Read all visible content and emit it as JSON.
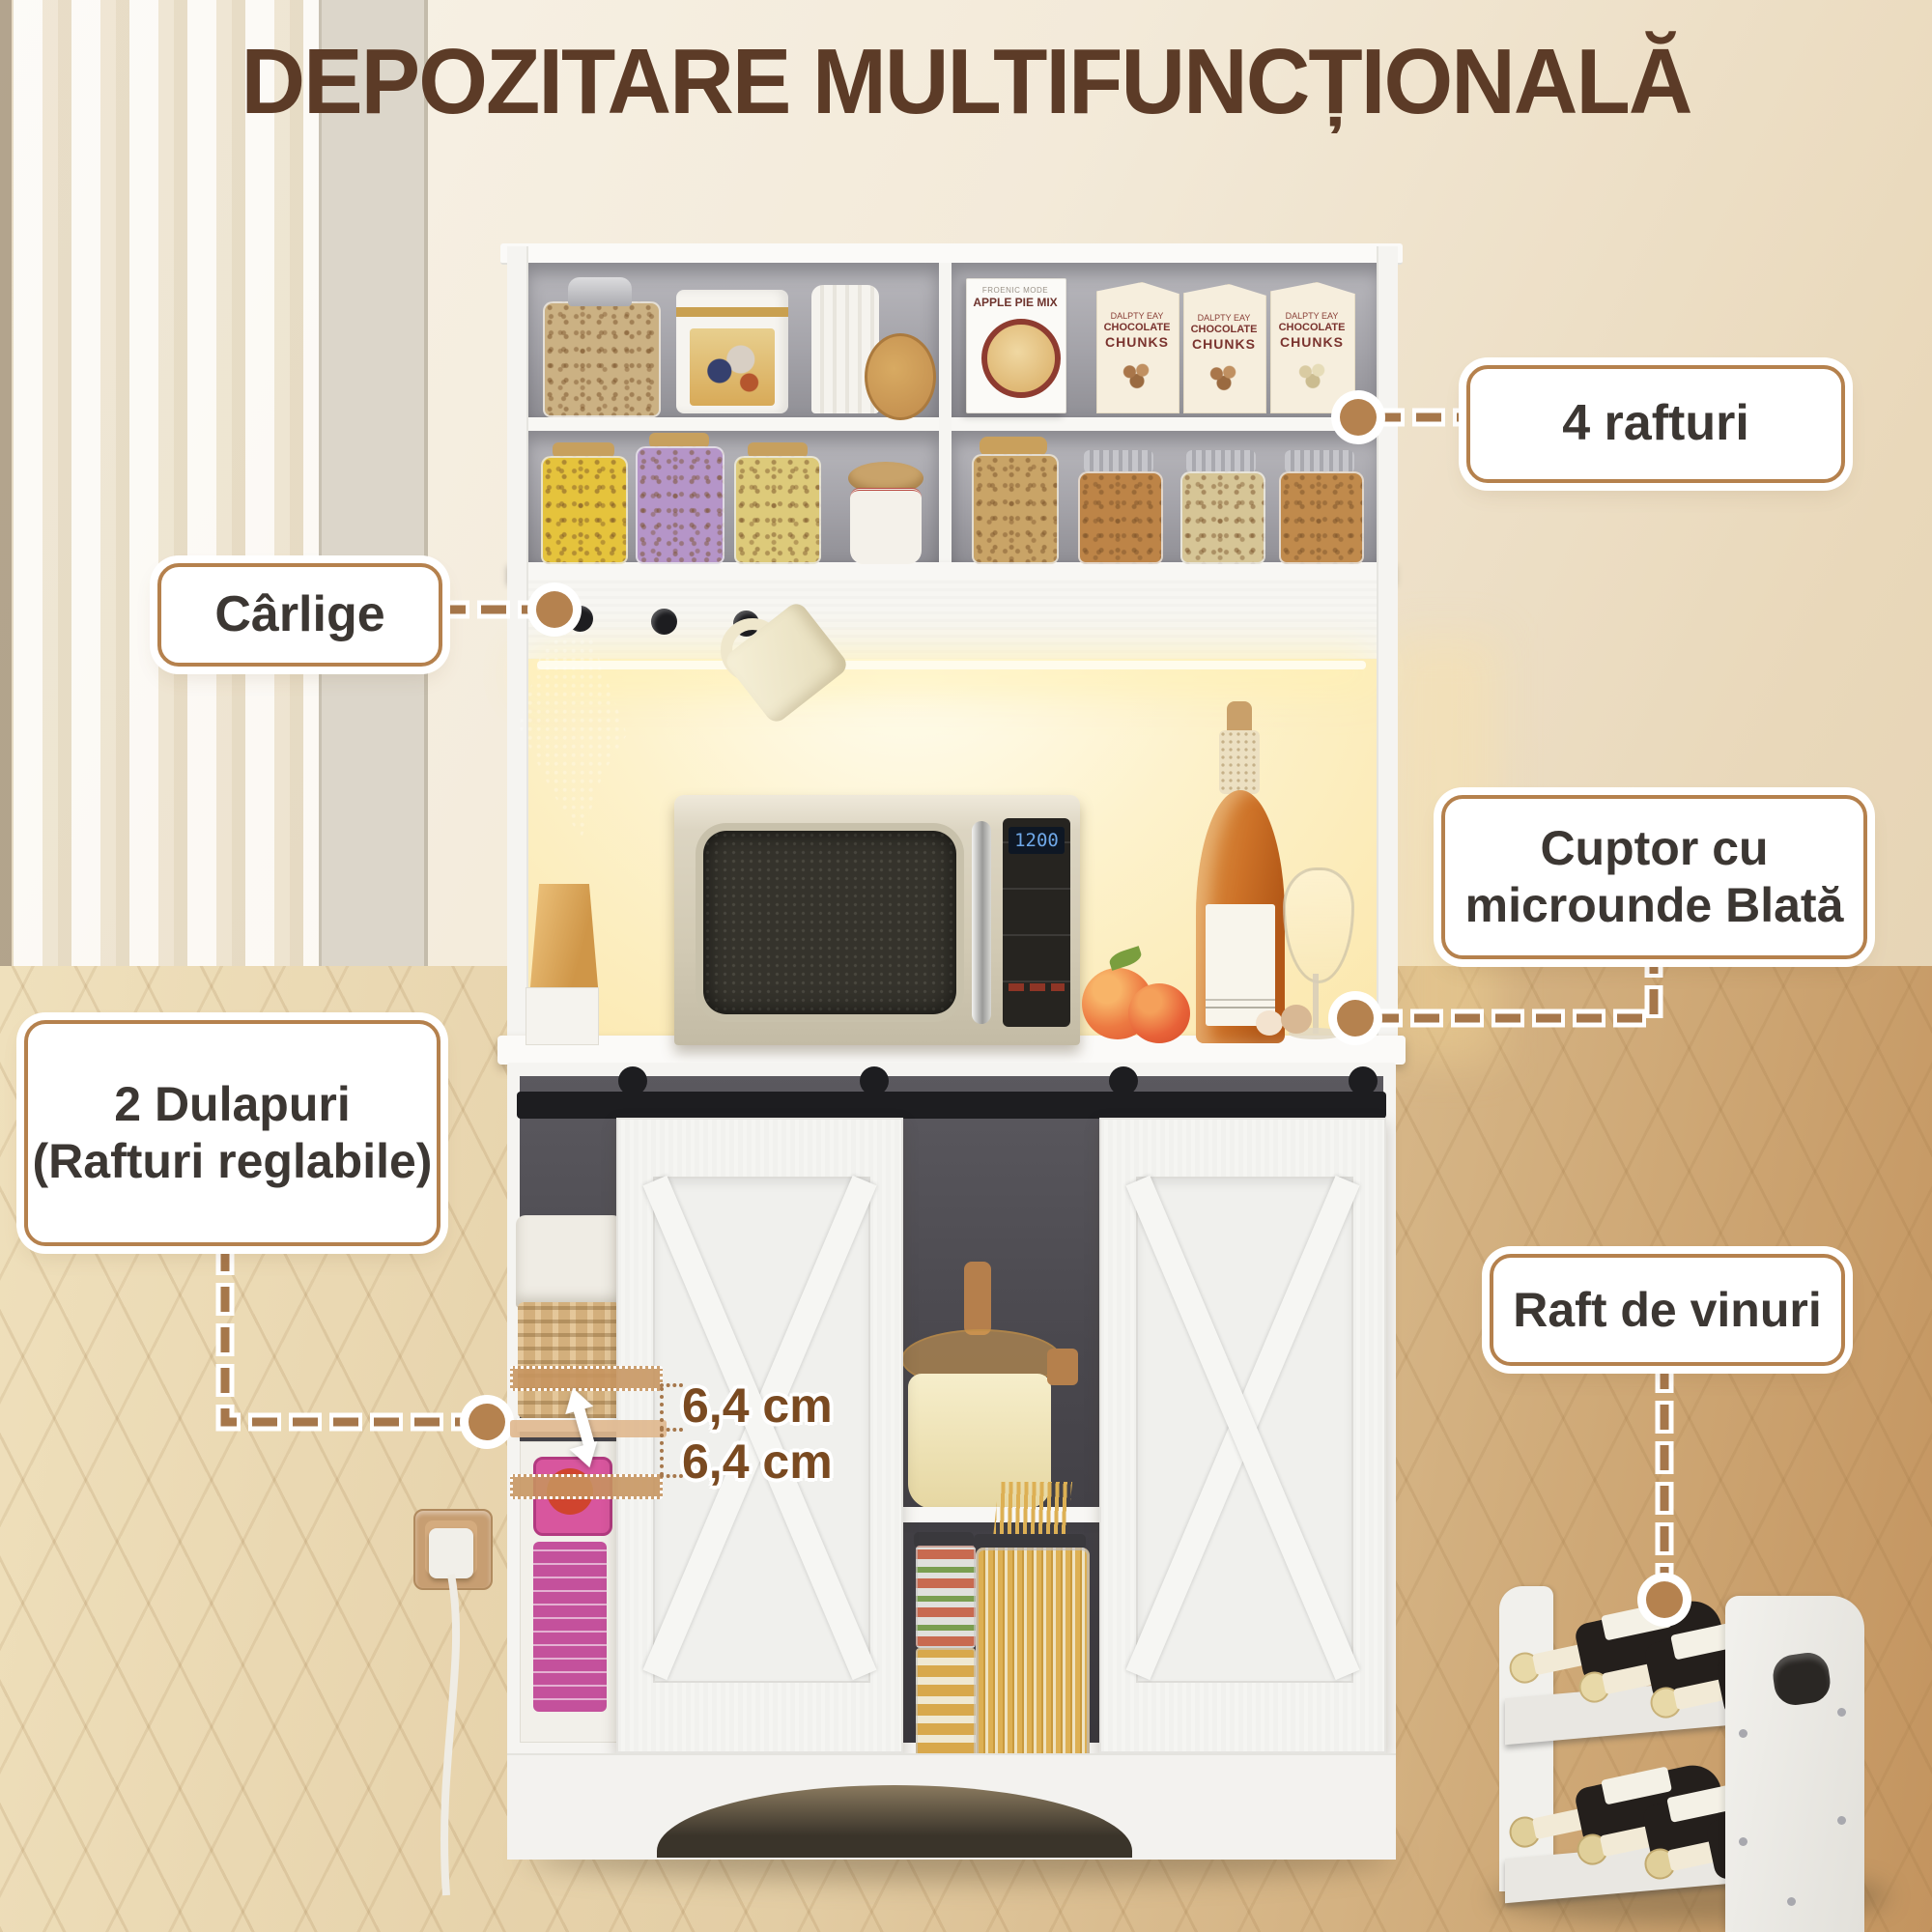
{
  "title": "DEPOZITARE MULTIFUNCȚIONALĂ",
  "callouts": {
    "shelves": {
      "label": "4 rafturi"
    },
    "hooks": {
      "label": "Cârlige"
    },
    "microwave": {
      "line1": "Cuptor cu",
      "line2": "microunde Blată"
    },
    "cabinets": {
      "line1": "2 Dulapuri",
      "line2": "(Rafturi reglabile)"
    },
    "wine_rack": {
      "label": "Raft de vinuri"
    }
  },
  "measurements": {
    "upper": "6,4 cm",
    "lower": "6,4 cm"
  },
  "products": {
    "apple_pie_box": {
      "brand": "FROENIC MODE",
      "name": "APPLE PIE MIX"
    },
    "chocolate_box": {
      "brand": "DALPTY EAY",
      "line1": "CHOCOLATE",
      "line2": "CHUNKS"
    }
  },
  "microwave": {
    "display": "1200"
  },
  "colors": {
    "title_text": "#5c3b27",
    "accent_border": "#b5814d",
    "dash_line": "#a6774b",
    "dot_fill": "#b5824f",
    "label_text": "#3c3733",
    "measure_text": "#7a4a21"
  }
}
